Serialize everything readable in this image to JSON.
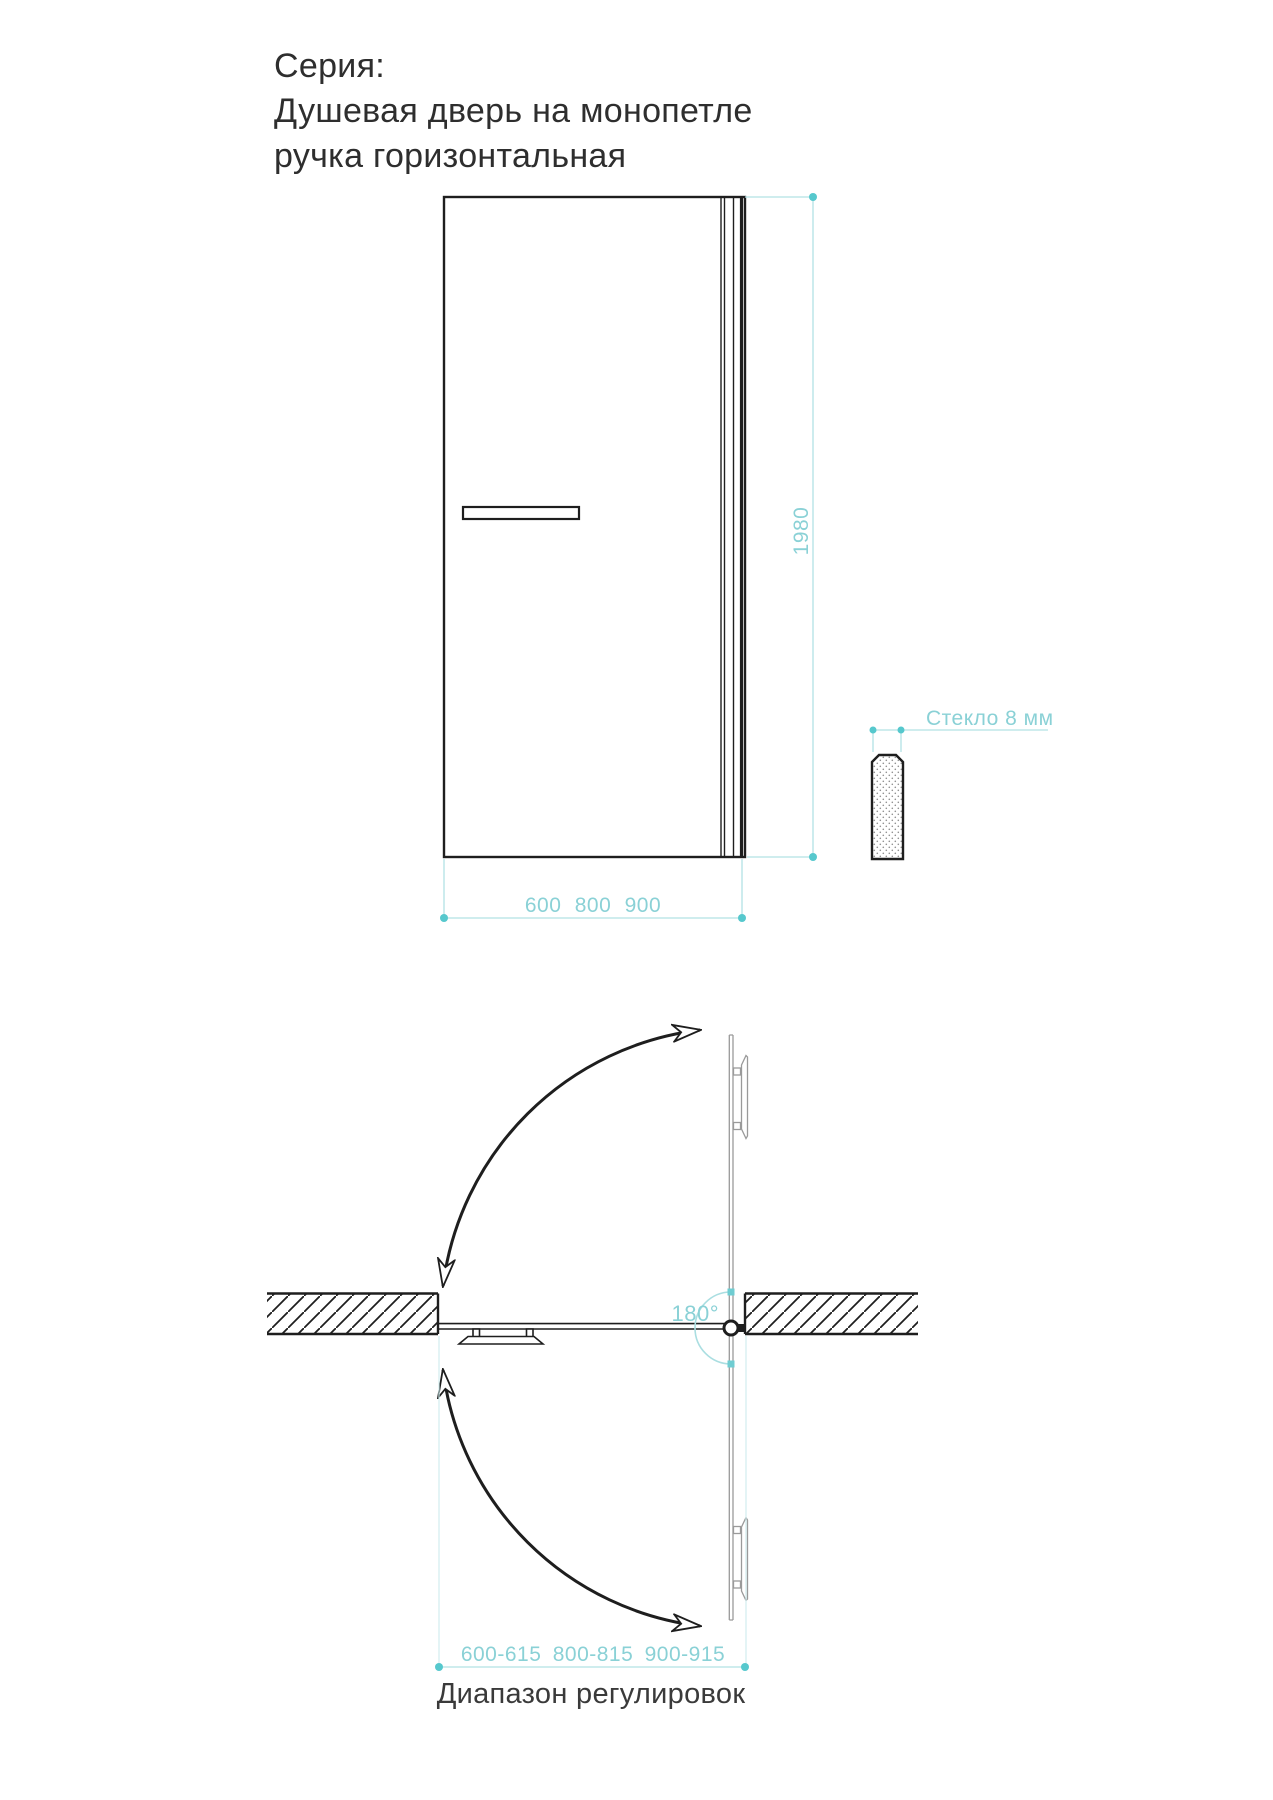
{
  "title": {
    "series_label": "Серия:",
    "product_name_line1": "Душевая дверь на монопетле",
    "product_name_line2": "ручка горизонтальная"
  },
  "front_view": {
    "height_dimension_mm": "1980",
    "width_options_mm": "600 800 900"
  },
  "glass_section": {
    "label": "Стекло 8 мм"
  },
  "plan_view": {
    "swing_angle_label": "180°",
    "adjustment_range_options_mm": "600-615 800-815 900-915",
    "caption": "Диапазон регулировок"
  },
  "colors": {
    "drawing_black": "#1e1e1e",
    "open_door_gray": "#9a9a9a",
    "dimension_teal_text": "#8ad1d6",
    "dimension_teal_line": "#b2e2e4",
    "dimension_teal_dot": "#56c8cd",
    "angle_arc_teal": "#aadee1",
    "title_text": "#2e2e2e",
    "caption_text": "#3a3a3a"
  }
}
